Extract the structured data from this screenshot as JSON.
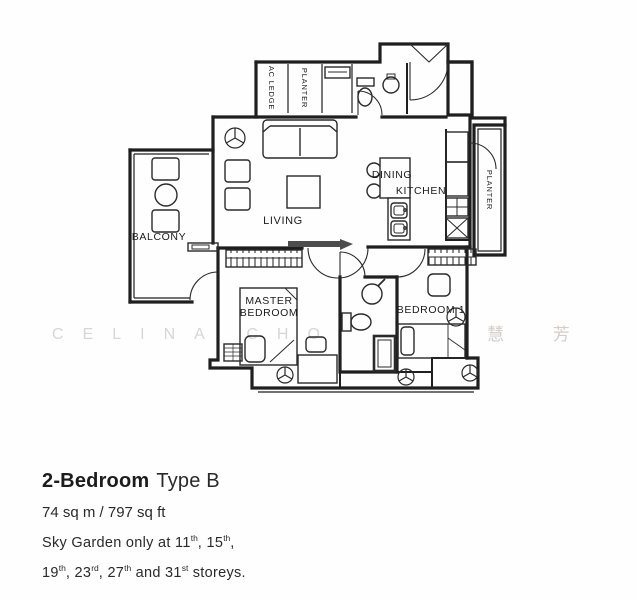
{
  "plan": {
    "labels": {
      "balcony": "BALCONY",
      "living": "LIVING",
      "dining": "DINING",
      "kitchen": "KITCHEN",
      "master1": "MASTER",
      "master2": "BEDROOM",
      "bedroom1": "BEDROOM 1",
      "ac_ledge": "AC LEDGE",
      "planter_top": "PLANTER",
      "planter_right": "PLANTER"
    },
    "watermark": {
      "latin": "CELINA CHO",
      "cjk": "慧 芳"
    }
  },
  "footer": {
    "title_bold": "2-Bedroom",
    "title_rest": "Type B",
    "area": "74 sq m / 797 sq ft",
    "sky1": {
      "t0": "Sky Garden only at 11",
      "s0": "th",
      "t1": ", 15",
      "s1": "th",
      "t2": ","
    },
    "sky2": {
      "t0": "19",
      "s0": "th",
      "t1": ", 23",
      "s1": "rd",
      "t2": ", 27",
      "s2": "th",
      "t3": " and 31",
      "s3": "st",
      "t4": " storeys."
    }
  },
  "colors": {
    "wall_line": "#1f1f1f",
    "fixture_line": "#2a2a2a",
    "sliding_door": "#4d4d4d",
    "watermark_latin": "#cdcdcd",
    "watermark_cjk": "#ccc5bf",
    "background": "#fefefe"
  }
}
